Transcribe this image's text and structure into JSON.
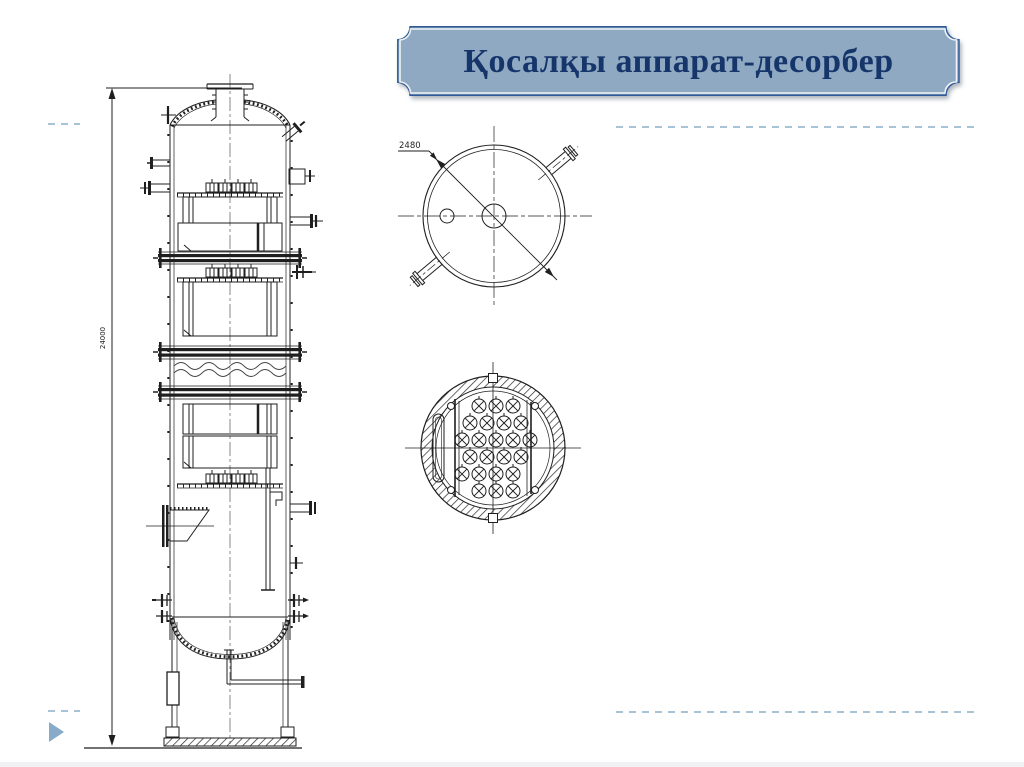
{
  "slide": {
    "title": "Қосалқы аппарат-десорбер",
    "title_bg": "#8ea9c1",
    "title_border": "#2f5a96",
    "title_text_color": "#16356b"
  },
  "drawing": {
    "line_color": "#1f1f1f",
    "labels": {
      "diameter": "2480",
      "height": "24000"
    },
    "views": {
      "elevation": "desorber-column-elevation",
      "top": "column-top-view",
      "section": "tube-sheet-section"
    }
  },
  "decor": {
    "dash_color": "#a9c3d6",
    "play_arrow_color": "#87abc9"
  }
}
